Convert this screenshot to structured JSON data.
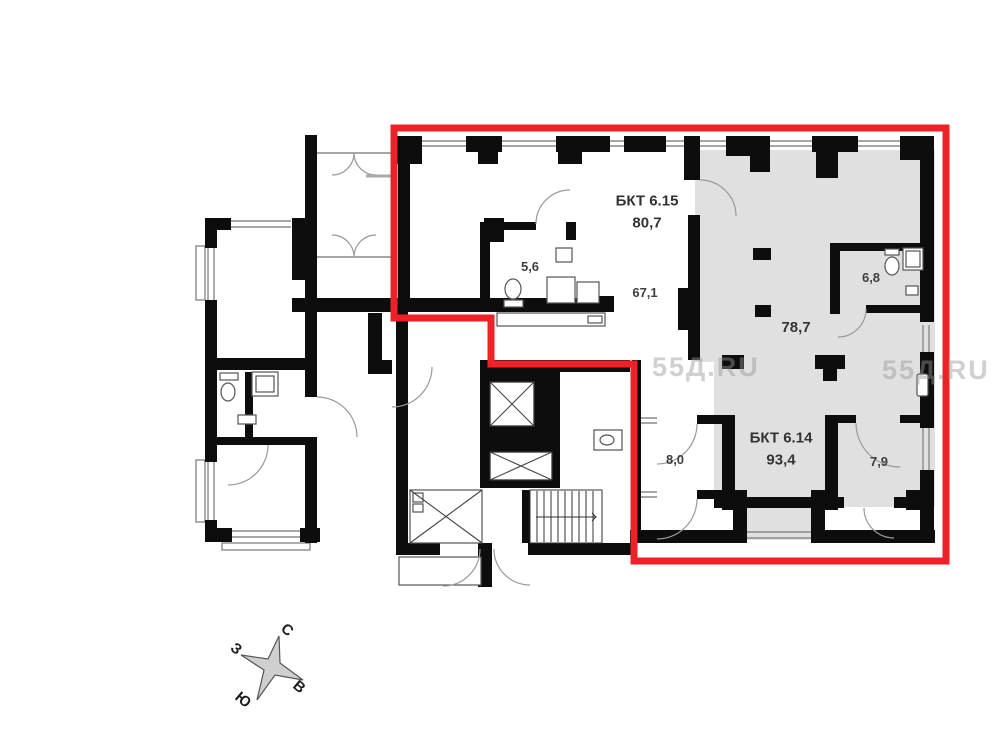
{
  "plan": {
    "apartments": [
      {
        "id": "bkt-6-15",
        "name": "БКТ 6.15",
        "area": "80,7"
      },
      {
        "id": "bkt-6-14",
        "name": "БКТ 6.14",
        "area": "93,4"
      }
    ],
    "rooms": [
      {
        "label": "5,6"
      },
      {
        "label": "67,1"
      },
      {
        "label": "6,8"
      },
      {
        "label": "78,7"
      },
      {
        "label": "8,0"
      },
      {
        "label": "7,9"
      }
    ]
  },
  "compass": {
    "north": "С",
    "south": "Ю",
    "west": "З",
    "east": "В"
  },
  "watermark": {
    "text": "55Д.RU"
  },
  "colors": {
    "highlight": "#ee2226",
    "room_fill": "#e0e0e0",
    "wall": "#0d0d0d"
  }
}
